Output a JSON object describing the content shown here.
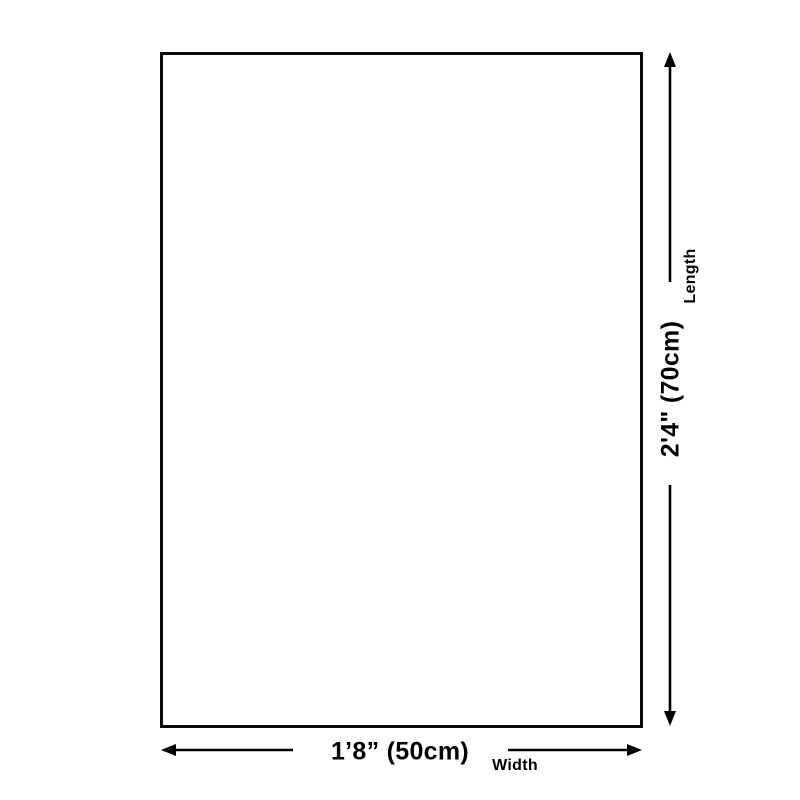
{
  "diagram": {
    "background_color": "#ffffff",
    "line_color": "#000000",
    "text_color": "#000000",
    "length": {
      "value": "2'4\" (70cm)",
      "label": "Length"
    },
    "width": {
      "value": "1’8” (50cm)",
      "label": "Width"
    }
  }
}
